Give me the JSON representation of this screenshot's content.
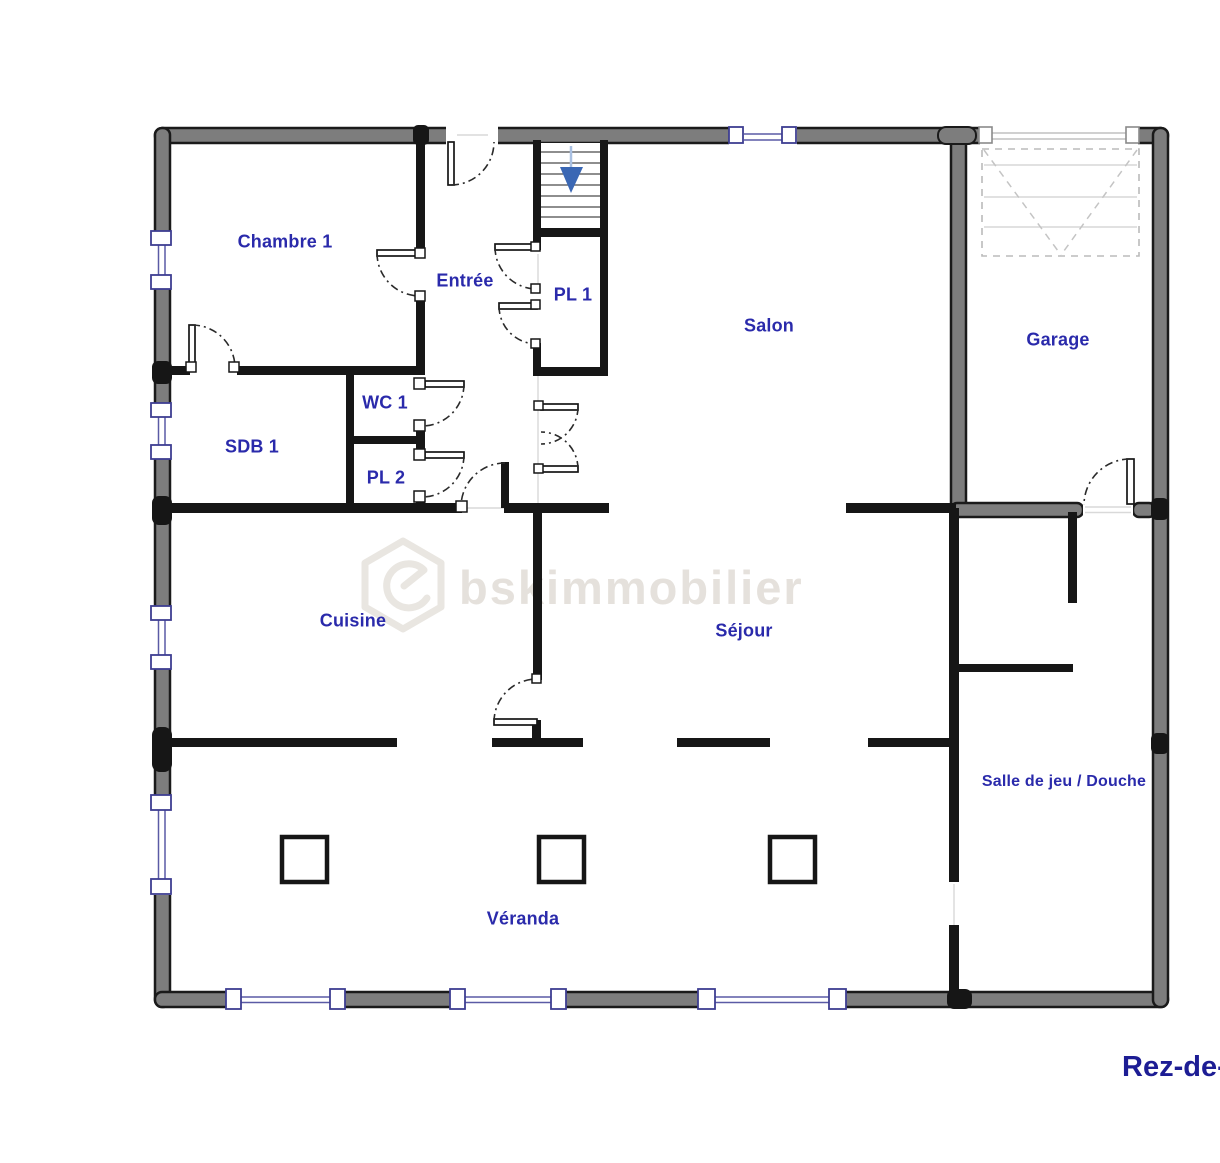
{
  "floor_plan": {
    "floor_label": "Rez-de-c",
    "watermark": {
      "text": "bskimmobilier",
      "logo_icon": "hexagon-house-swirl-logo"
    },
    "rooms": [
      {
        "id": "chambre-1",
        "label": "Chambre 1"
      },
      {
        "id": "entree",
        "label": "Entrée"
      },
      {
        "id": "pl-1",
        "label": "PL 1"
      },
      {
        "id": "salon",
        "label": "Salon"
      },
      {
        "id": "garage",
        "label": "Garage"
      },
      {
        "id": "wc-1",
        "label": "WC 1"
      },
      {
        "id": "sdb-1",
        "label": "SDB 1"
      },
      {
        "id": "pl-2",
        "label": "PL 2"
      },
      {
        "id": "cuisine",
        "label": "Cuisine"
      },
      {
        "id": "sejour",
        "label": "Séjour"
      },
      {
        "id": "salle-de-jeu",
        "label": "Salle de jeu / Douche"
      },
      {
        "id": "veranda",
        "label": "Véranda"
      }
    ],
    "symbols": {
      "stairs_arrow_icon": "arrow-down",
      "garage_door_icon": "sectional-garage-door"
    },
    "colors": {
      "room_label": "#2a2aab",
      "floor_label": "#1d1d94",
      "outer_wall": "#7d7d7d",
      "inner_wall": "#161616",
      "window_frame": "#3e3e92",
      "stairs_arrow": "#3a67b4",
      "watermark": "#e5e1dc"
    }
  }
}
